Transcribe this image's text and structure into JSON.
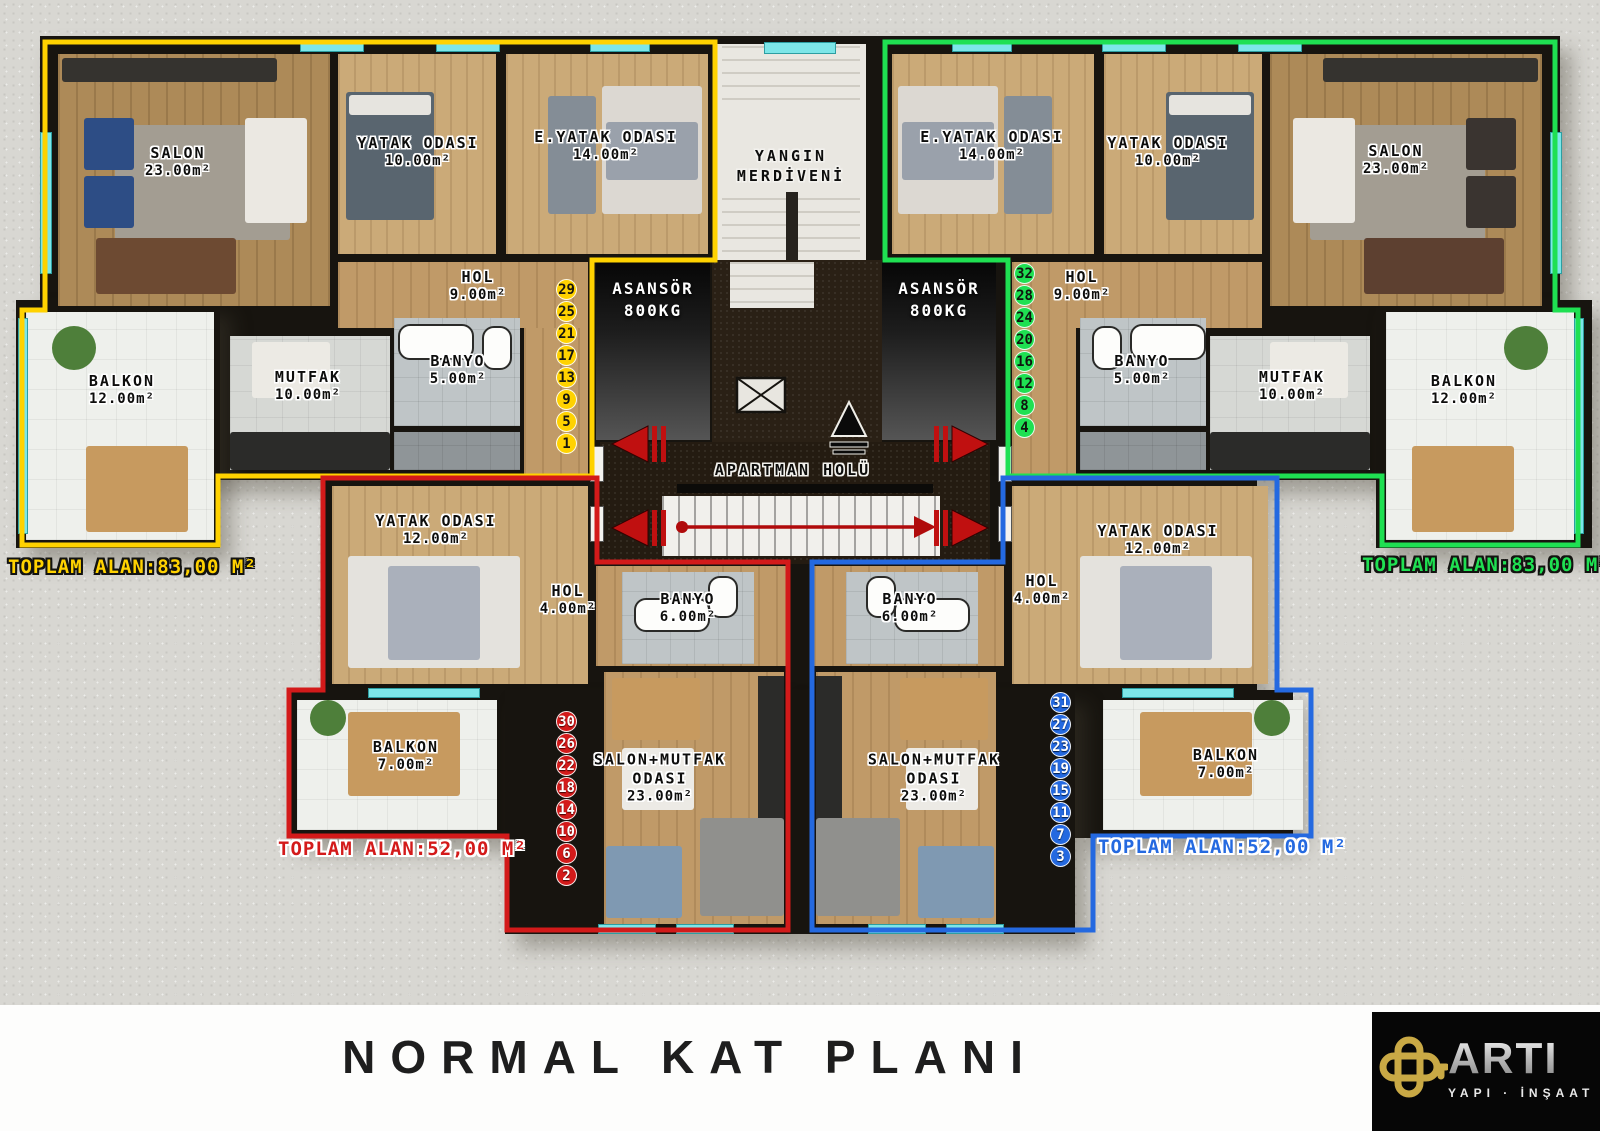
{
  "title": "NORMAL KAT PLANI",
  "colors": {
    "yellow": "#ffd200",
    "green": "#1fe052",
    "red": "#d31a1a",
    "blue": "#2469e0"
  },
  "core": {
    "fire_escape": {
      "line1": "YANGIN",
      "line2": "MERDİVENİ"
    },
    "elevator": {
      "line1": "ASANSÖR",
      "line2": "800KG"
    },
    "lobby": "APARTMAN HOLÜ"
  },
  "apartments": {
    "top_left": {
      "total": "TOPLAM ALAN:83,00 M²",
      "units": [
        "29",
        "25",
        "21",
        "17",
        "13",
        "9",
        "5",
        "1"
      ],
      "rooms": {
        "salon": {
          "name": "SALON",
          "area": "23.00m²"
        },
        "yatak_odasi": {
          "name": "YATAK ODASI",
          "area": "10.00m²"
        },
        "ebeveyn_yatak": {
          "name": "E.YATAK ODASI",
          "area": "14.00m²"
        },
        "hol": {
          "name": "HOL",
          "area": "9.00m²"
        },
        "banyo": {
          "name": "BANYO",
          "area": "5.00m²"
        },
        "mutfak": {
          "name": "MUTFAK",
          "area": "10.00m²"
        },
        "balkon": {
          "name": "BALKON",
          "area": "12.00m²"
        }
      }
    },
    "top_right": {
      "total": "TOPLAM ALAN:83,00 M²",
      "units": [
        "32",
        "28",
        "24",
        "20",
        "16",
        "12",
        "8",
        "4"
      ],
      "rooms": {
        "ebeveyn_yatak": {
          "name": "E.YATAK ODASI",
          "area": "14.00m²"
        },
        "yatak_odasi": {
          "name": "YATAK ODASI",
          "area": "10.00m²"
        },
        "salon": {
          "name": "SALON",
          "area": "23.00m²"
        },
        "hol": {
          "name": "HOL",
          "area": "9.00m²"
        },
        "banyo": {
          "name": "BANYO",
          "area": "5.00m²"
        },
        "mutfak": {
          "name": "MUTFAK",
          "area": "10.00m²"
        },
        "balkon": {
          "name": "BALKON",
          "area": "12.00m²"
        }
      }
    },
    "bottom_left": {
      "total": "TOPLAM ALAN:52,00 M²",
      "units": [
        "30",
        "26",
        "22",
        "18",
        "14",
        "10",
        "6",
        "2"
      ],
      "rooms": {
        "yatak_odasi": {
          "name": "YATAK ODASI",
          "area": "12.00m²"
        },
        "hol": {
          "name": "HOL",
          "area": "4.00m²"
        },
        "banyo": {
          "name": "BANYO",
          "area": "6.00m²"
        },
        "salon_mutfak": {
          "line1": "SALON+MUTFAK",
          "line2": "ODASI",
          "area": "23.00m²"
        },
        "balkon": {
          "name": "BALKON",
          "area": "7.00m²"
        }
      }
    },
    "bottom_right": {
      "total": "TOPLAM ALAN:52,00 M²",
      "units": [
        "31",
        "27",
        "23",
        "19",
        "15",
        "11",
        "7",
        "3"
      ],
      "rooms": {
        "yatak_odasi": {
          "name": "YATAK ODASI",
          "area": "12.00m²"
        },
        "hol": {
          "name": "HOL",
          "area": "4.00m²"
        },
        "banyo": {
          "name": "BANYO",
          "area": "6.00m²"
        },
        "salon_mutfak": {
          "line1": "SALON+MUTFAK",
          "line2": "ODASI",
          "area": "23.00m²"
        },
        "balkon": {
          "name": "BALKON",
          "area": "7.00m²"
        }
      }
    }
  },
  "logo": {
    "brand": "ARTI",
    "subtitle": "YAPI · İNŞAAT"
  }
}
